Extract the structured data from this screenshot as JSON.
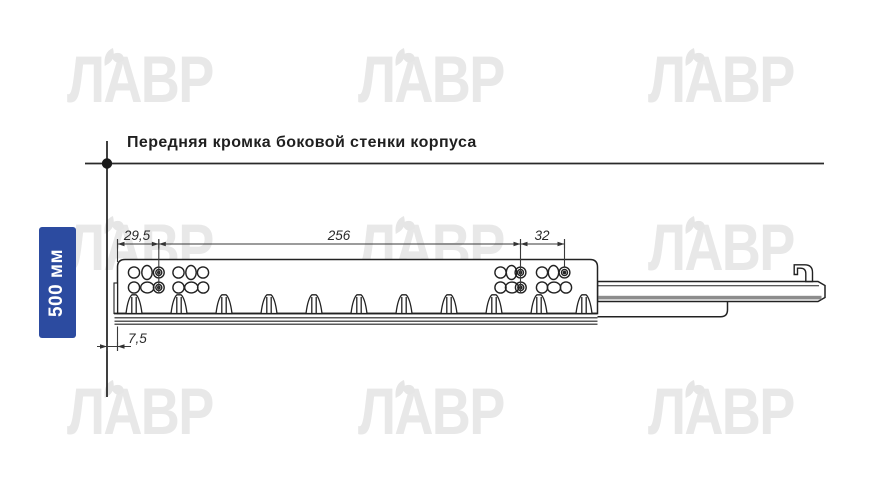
{
  "title": "Передняя кромка боковой стенки корпуса",
  "side_label": {
    "text": "500 мм",
    "background": "#2c4ba0",
    "text_color": "#ffffff"
  },
  "watermark": {
    "text": "ЛАВР",
    "color": "#e8e8e8"
  },
  "dimensions": {
    "front_offset": "29,5",
    "mounting_span": "256",
    "rear_pitch": "32",
    "bottom_offset": "7,5"
  },
  "drawing_colors": {
    "line": "#2a2a2a",
    "rail_band": "#8c8c8c"
  }
}
